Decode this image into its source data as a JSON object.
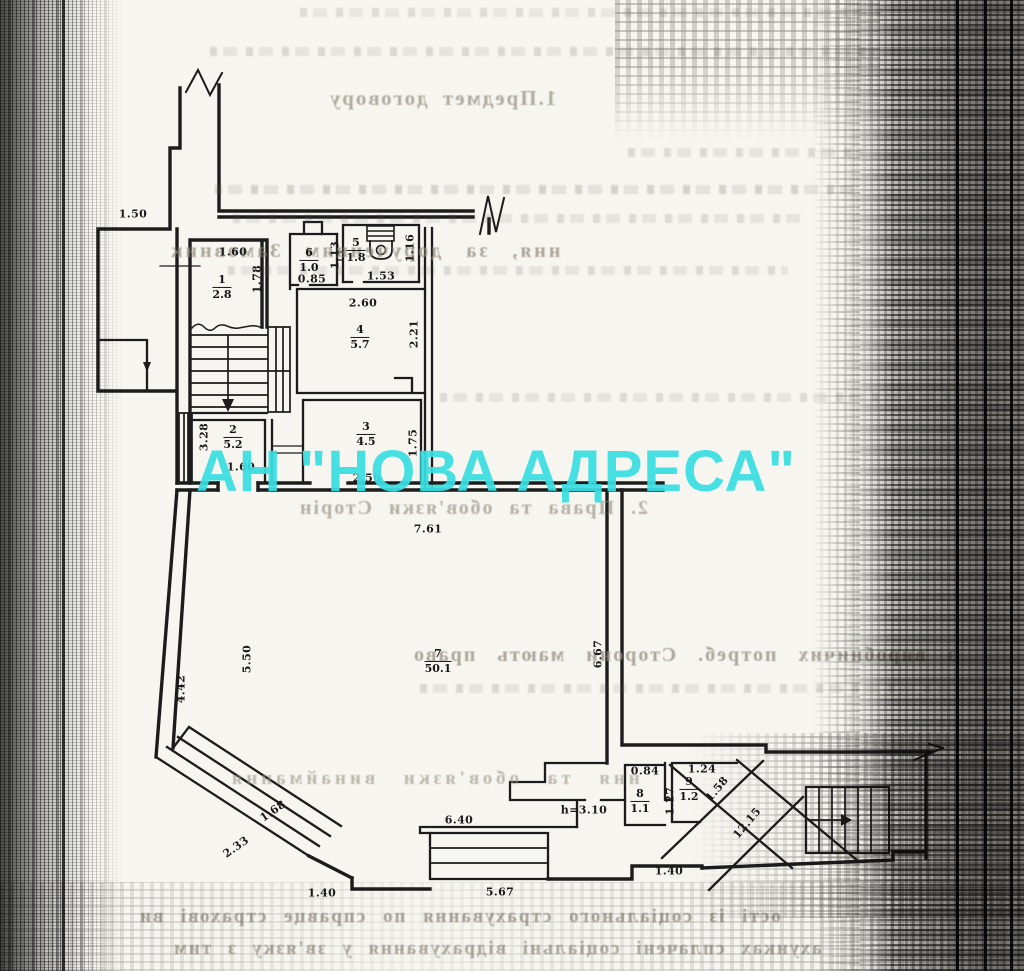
{
  "watermark": {
    "text": "АН \"НОВА АДРЕСА\"",
    "color": "#39dfe3"
  },
  "colors": {
    "ink": "#1c1c1c",
    "paper": "#f6f5f0",
    "bleed_text": "#978f80"
  },
  "plan": {
    "rooms": [
      {
        "num": "1",
        "area": "2.8",
        "x": 222,
        "y": 287
      },
      {
        "num": "2",
        "area": "5.2",
        "x": 233,
        "y": 437
      },
      {
        "num": "3",
        "area": "4.5",
        "x": 366,
        "y": 434
      },
      {
        "num": "4",
        "area": "5.7",
        "x": 360,
        "y": 337
      },
      {
        "num": "5",
        "area": "1.8",
        "x": 356,
        "y": 250
      },
      {
        "num": "6",
        "area": "1.0",
        "x": 309,
        "y": 260
      },
      {
        "num": "7",
        "area": "50.1",
        "x": 438,
        "y": 661
      },
      {
        "num": "8",
        "area": "1.1",
        "x": 640,
        "y": 801
      },
      {
        "num": "9",
        "area": "1.2",
        "x": 689,
        "y": 789
      }
    ],
    "dimensions": [
      {
        "text": "1.50",
        "x": 133,
        "y": 214,
        "rot": 0
      },
      {
        "text": "1.60",
        "x": 233,
        "y": 252,
        "rot": 0
      },
      {
        "text": "1.78",
        "x": 257,
        "y": 279,
        "rot": -90
      },
      {
        "text": "0.85",
        "x": 312,
        "y": 279,
        "rot": 0
      },
      {
        "text": "1.13",
        "x": 335,
        "y": 255,
        "rot": -90
      },
      {
        "text": "1.53",
        "x": 381,
        "y": 276,
        "rot": 0
      },
      {
        "text": "1.16",
        "x": 410,
        "y": 248,
        "rot": -90
      },
      {
        "text": "2.60",
        "x": 363,
        "y": 303,
        "rot": 0
      },
      {
        "text": "2.21",
        "x": 414,
        "y": 334,
        "rot": -90
      },
      {
        "text": "3.28",
        "x": 204,
        "y": 437,
        "rot": -90
      },
      {
        "text": "1.60",
        "x": 241,
        "y": 467,
        "rot": 0
      },
      {
        "text": "1.75",
        "x": 413,
        "y": 443,
        "rot": -90
      },
      {
        "text": "2.56",
        "x": 367,
        "y": 478,
        "rot": 0
      },
      {
        "text": "7.61",
        "x": 428,
        "y": 529,
        "rot": 0
      },
      {
        "text": "5.50",
        "x": 247,
        "y": 659,
        "rot": -90
      },
      {
        "text": "4.42",
        "x": 181,
        "y": 689,
        "rot": -90
      },
      {
        "text": "6.67",
        "x": 598,
        "y": 654,
        "rot": -90
      },
      {
        "text": "1.68",
        "x": 273,
        "y": 811,
        "rot": -35
      },
      {
        "text": "2.33",
        "x": 236,
        "y": 847,
        "rot": -35
      },
      {
        "text": "6.40",
        "x": 459,
        "y": 820,
        "rot": 0
      },
      {
        "text": "5.67",
        "x": 500,
        "y": 892,
        "rot": 0
      },
      {
        "text": "1.40",
        "x": 322,
        "y": 893,
        "rot": 0
      },
      {
        "text": "1.40",
        "x": 669,
        "y": 871,
        "rot": 0
      },
      {
        "text": "h=3.10",
        "x": 584,
        "y": 810,
        "rot": 0
      },
      {
        "text": "0.84",
        "x": 645,
        "y": 771,
        "rot": 0
      },
      {
        "text": "1.27",
        "x": 670,
        "y": 801,
        "rot": -90
      },
      {
        "text": "1.24",
        "x": 702,
        "y": 769,
        "rot": 0
      },
      {
        "text": "1.58",
        "x": 717,
        "y": 789,
        "rot": -50
      },
      {
        "text": "12.15",
        "x": 747,
        "y": 823,
        "rot": -50
      }
    ]
  },
  "bleedthrough": {
    "lines": [
      {
        "text": "1.Предмет договору",
        "x": 328,
        "y": 86,
        "size": 21,
        "ls": 2,
        "ws": 6,
        "op": 0.72
      },
      {
        "text": "ння, за дорученням  Замовник",
        "x": 168,
        "y": 240,
        "size": 20,
        "ls": 3,
        "ws": 14,
        "op": 0.78
      },
      {
        "text": "2. Права та обов'язки Сторін",
        "x": 298,
        "y": 497,
        "size": 20,
        "ls": 2,
        "ws": 8,
        "op": 0.68
      },
      {
        "text": "з виробничих потреб.  Сторони  мають  право",
        "x": 412,
        "y": 644,
        "size": 20,
        "ls": 2,
        "ws": 13,
        "op": 0.78
      },
      {
        "text": "ння та обов'язки винаймання",
        "x": 228,
        "y": 768,
        "size": 19,
        "ls": 4,
        "ws": 16,
        "op": 0.6
      },
      {
        "text": "ості із соціального страхування  по справце страхові ви",
        "x": 138,
        "y": 906,
        "size": 19,
        "ls": 2,
        "ws": 9,
        "op": 0.82
      },
      {
        "text": "ахунках сплачені соціальні відрахування у зв'язку з тим",
        "x": 172,
        "y": 938,
        "size": 19,
        "ls": 2,
        "ws": 8,
        "op": 0.76
      }
    ]
  }
}
